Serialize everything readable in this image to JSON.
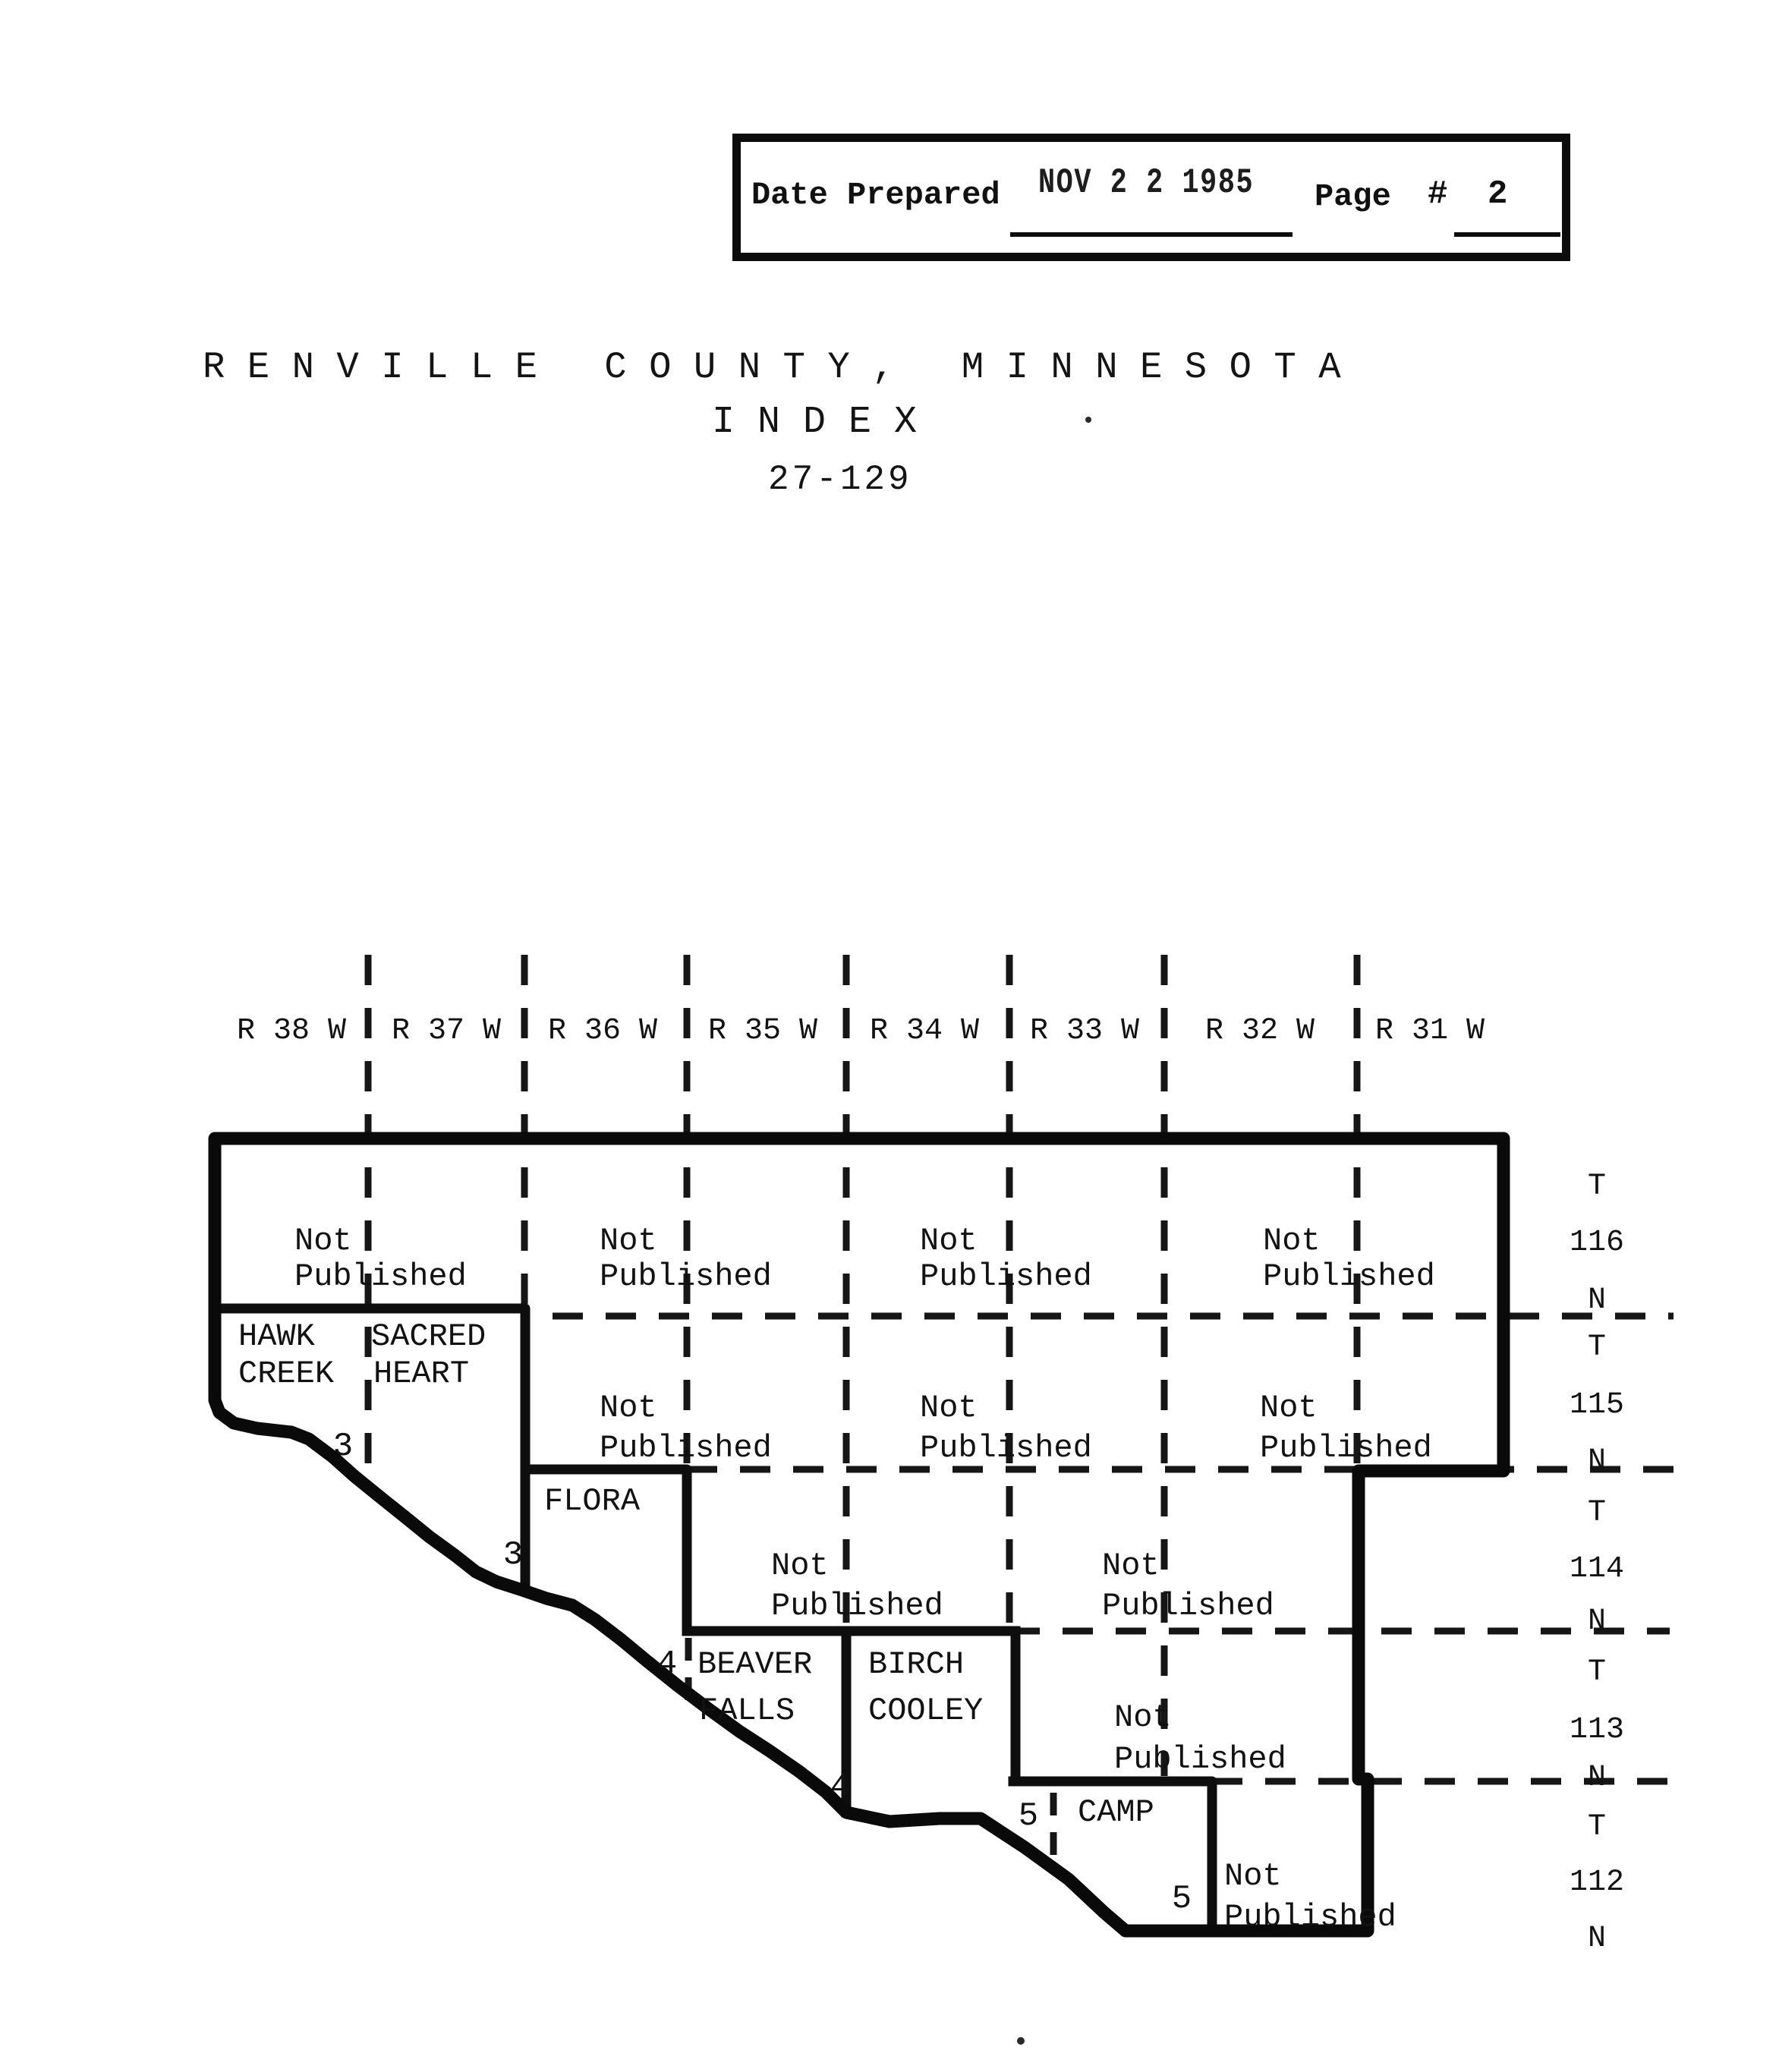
{
  "stamp_box": {
    "date_prepared_label": "Date Prepared",
    "date_stamp": "NOV 2 2 1985",
    "page_label": "Page",
    "number_sign_label": "#",
    "page_number": "2"
  },
  "title": {
    "county_line": "R E N V I L L E   C O U N T Y ,   M I N N E S O T A",
    "index_line": "I N D E X",
    "range_line": "27-129"
  },
  "map": {
    "range_labels": [
      "R 38 W",
      "R 37 W",
      "R 36 W",
      "R 35 W",
      "R 34 W",
      "R 33 W",
      "R 32 W",
      "R 31 W"
    ],
    "township_rows": [
      {
        "t": "T",
        "num": "116",
        "n": "N"
      },
      {
        "t": "T",
        "num": "115",
        "n": "N"
      },
      {
        "t": "T",
        "num": "114",
        "n": "N"
      },
      {
        "t": "T",
        "num": "113",
        "n": "N"
      },
      {
        "t": "T",
        "num": "112",
        "n": "N"
      }
    ],
    "townships": {
      "hawk_creek": {
        "line1": "HAWK",
        "line2": "CREEK"
      },
      "sacred_heart": {
        "line1": "SACRED",
        "line2": "HEART"
      },
      "flora": {
        "name": "FLORA"
      },
      "beaver_falls": {
        "line1": "BEAVER",
        "line2": "FALLS"
      },
      "birch_cooley": {
        "line1": "BIRCH",
        "line2": "COOLEY"
      },
      "camp": {
        "name": "CAMP"
      }
    },
    "not_published": {
      "line1": "Not",
      "line2": "Published"
    },
    "page_refs": [
      "3",
      "3",
      "4",
      "4",
      "5",
      "5"
    ]
  }
}
